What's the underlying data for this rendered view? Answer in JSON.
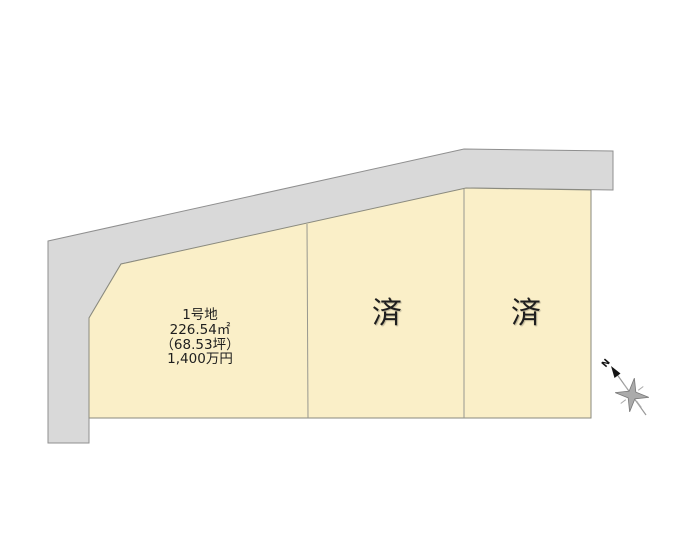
{
  "lots": [
    {
      "name": "1号地",
      "area_m2": "226.54㎡",
      "area_tsubo": "（68.53坪）",
      "price": "1,400万円"
    },
    {
      "status": "済"
    },
    {
      "status": "済"
    }
  ],
  "compass": {
    "north_label": "N"
  },
  "colors": {
    "lot_fill": "#FAEFC8",
    "road_fill": "#D9D9D9",
    "text": "#1E1E1E"
  }
}
